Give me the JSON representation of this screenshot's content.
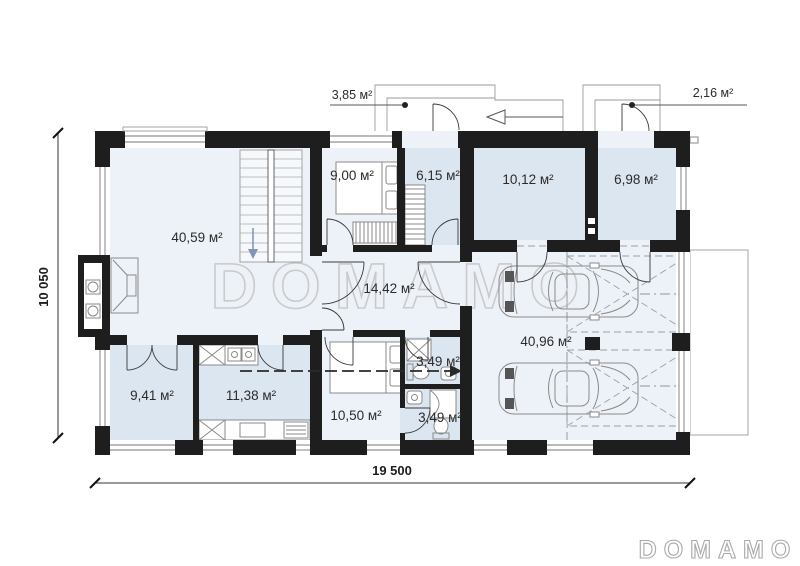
{
  "plan": {
    "watermark": "DOMAMO",
    "footer_logo": "DOMAMO",
    "dimensions": {
      "total_width": "19 500",
      "total_depth": "10 050"
    },
    "porches": [
      {
        "label": "3,85 м²"
      },
      {
        "label": "2,16 м²"
      }
    ],
    "rooms": [
      {
        "area": "40,59 м²"
      },
      {
        "area": "9,00 м²"
      },
      {
        "area": "6,15 м²"
      },
      {
        "area": "10,12 м²"
      },
      {
        "area": "6,98 м²"
      },
      {
        "area": "14,42 м²"
      },
      {
        "area": "40,96 м²"
      },
      {
        "area": "9,41 м²"
      },
      {
        "area": "11,38 м²"
      },
      {
        "area": "10,50 м²"
      },
      {
        "area": "3,49 м²"
      },
      {
        "area": "3,49 м²"
      }
    ],
    "colors": {
      "wall": "#1e1e1e",
      "room_light": "#edf2f8",
      "room_dark": "#dce6f1",
      "fixture_line": "#8a8a8a",
      "dark_line": "#3a3a3a",
      "watermark": "#c4c4c4",
      "brand": "#a9a9a9",
      "dim": "#1d1d1d",
      "dashed": "#9aa0a6",
      "stairs_arrow": "#7f93b8"
    }
  }
}
